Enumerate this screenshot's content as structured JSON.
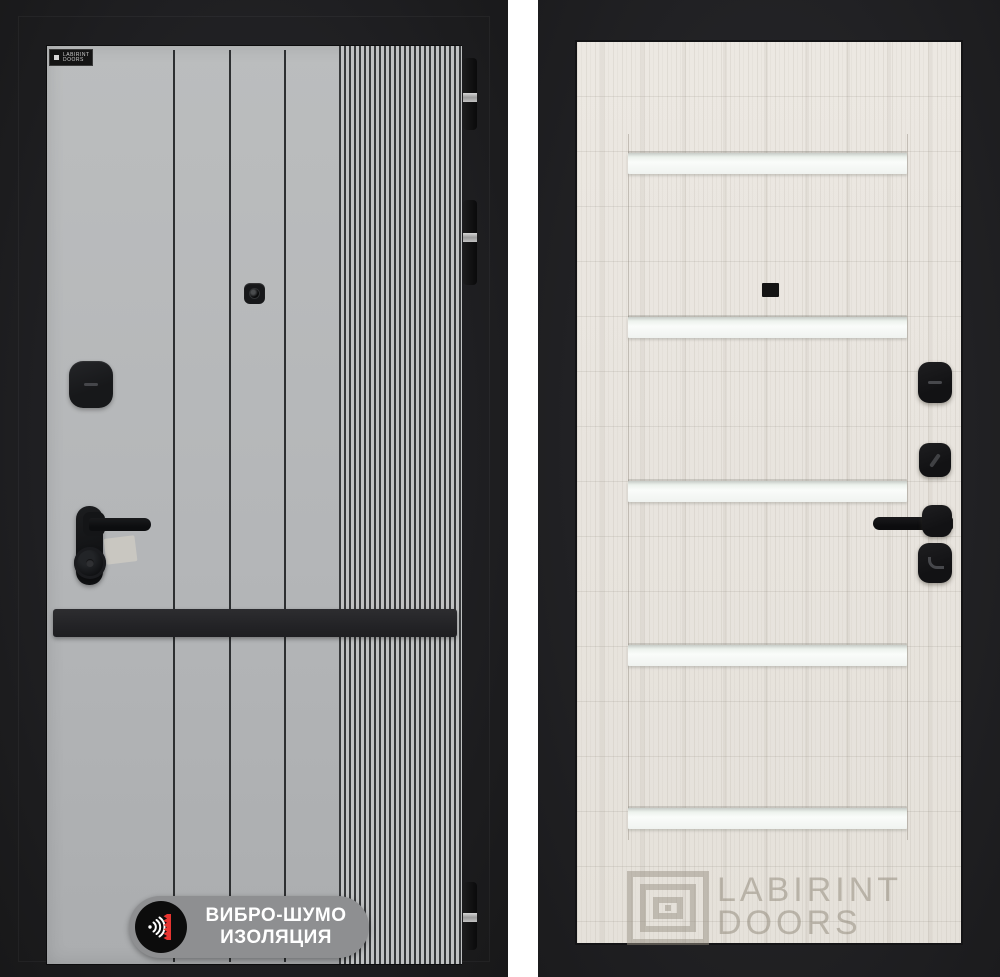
{
  "product_photo": {
    "subject": "entrance door, exterior and interior sides",
    "left_photo": {
      "side": "exterior",
      "panel_color": "#b6b8ba",
      "bumper_strip_color": "#232326",
      "brand_stamp": {
        "line1": "LABIRINT",
        "line2": "DOORS"
      },
      "badge": {
        "line1": "ВИБРО-ШУМО",
        "line2": "ИЗОЛЯЦИЯ",
        "pill_color": "#8e8f91",
        "text_color": "#ffffff",
        "icon": "sound-waves-icon",
        "icon_accent_color": "#e63430"
      },
      "hinge_count": 3
    },
    "right_photo": {
      "side": "interior",
      "panel_color": "#e9e5df",
      "glass_insert_color": "#f7faf7",
      "glass_insert_count": 5,
      "watermark": {
        "line1": "LABIRINT",
        "line2": "DOORS",
        "color": "#9b9487",
        "icon": "labyrinth-logo-icon"
      }
    }
  }
}
